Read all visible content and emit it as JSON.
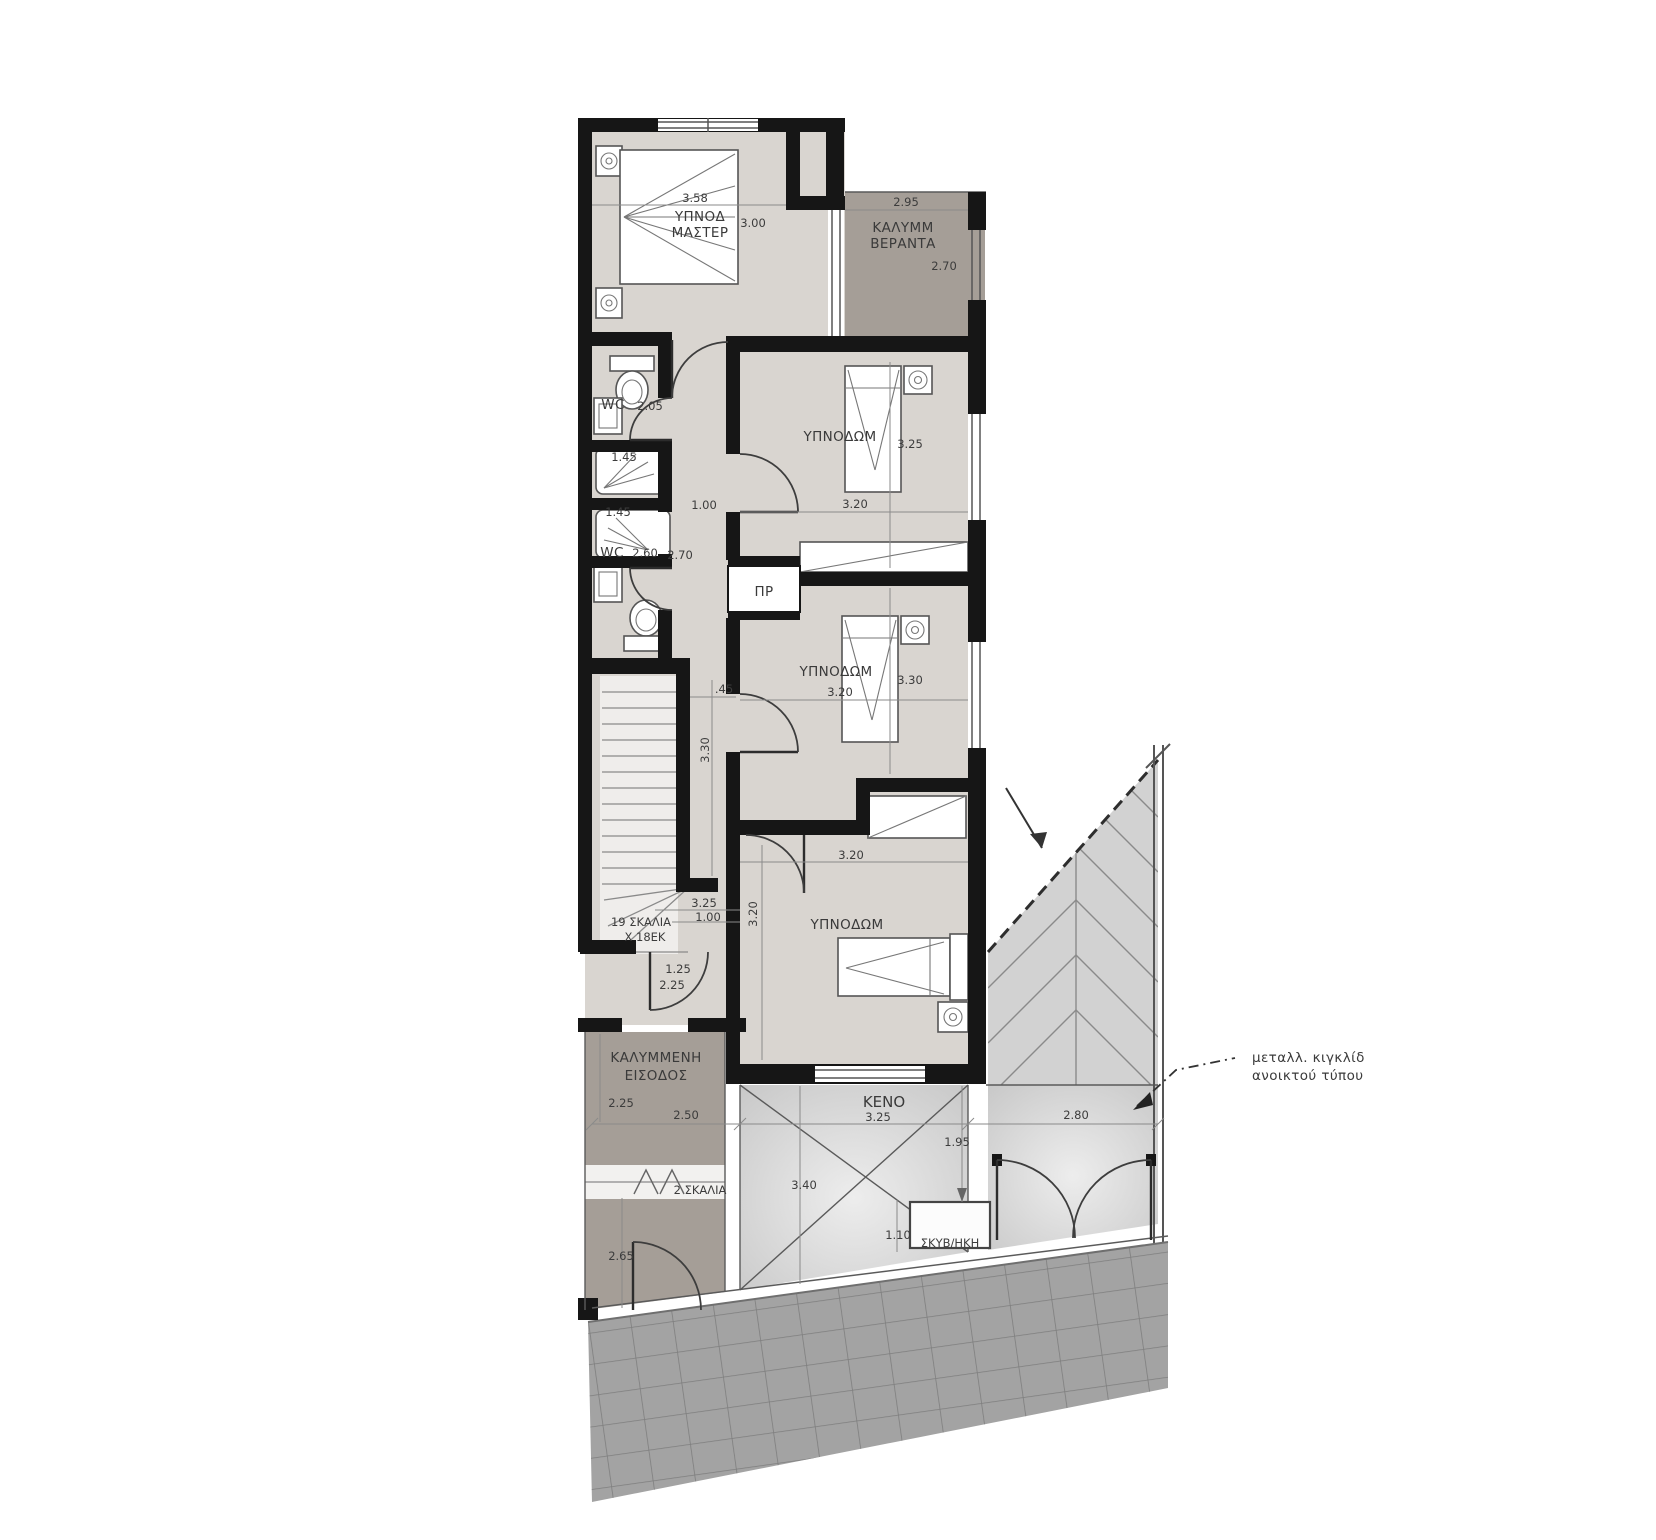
{
  "rooms": {
    "master": {
      "line1": "ΥΠΝΟΔ",
      "line2": "ΜΑΣΤΕΡ"
    },
    "veranda": {
      "line1": "ΚΑΛΥΜΜ",
      "line2": "ΒΕΡΑΝΤΑ"
    },
    "bedroom1": "ΥΠΝΟΔΩΜ",
    "bedroom2": "ΥΠΝΟΔΩΜ",
    "bedroom3": "ΥΠΝΟΔΩΜ",
    "wc1": "WC",
    "wc2": "WC",
    "closet": "ΠΡ",
    "stairs": {
      "line1": "19 ΣΚΑΛΙΑ",
      "line2": "Χ 18ΕΚ"
    },
    "steps2": "2 ΣΚΑΛΙΑ",
    "entrance": {
      "line1": "ΚΑΛΥΜΜΕΝΗ",
      "line2": "ΕΙΣΟΔΟΣ"
    },
    "void": "ΚΕΝΟ",
    "bin": "ΣΚΥΒ/ΗΚΗ"
  },
  "dims": {
    "master_w": "3.58",
    "master_h": "3.00",
    "veranda_w": "2.95",
    "veranda_h": "2.70",
    "wc1": "2.05",
    "shower1": "1.45",
    "shower2": "1.45",
    "wc2a": "2.60",
    "wc2b": "2.70",
    "corridor": "1.00",
    "bed1_h": "3.25",
    "bed1_w": "3.20",
    "bed2_h": "3.30",
    "bed2_w": "3.20",
    "offset": ".45",
    "hall_h": "3.30",
    "stair_w": "3.25",
    "stair_exit": "1.00",
    "entry_a": "1.25",
    "entry_b": "2.25",
    "bed3_w": "3.20",
    "bed3_h": "3.20",
    "porch_h": "2.25",
    "porch_w": "2.50",
    "void_w": "3.25",
    "void_h": "3.40",
    "side": "1.95",
    "gate": "2.80",
    "bin_h": "1.10",
    "lower_h": "2.65"
  },
  "annotations": {
    "railing": {
      "line1": "μεταλλ. κιγκλίδ",
      "line2": "ανοικτού τύπου"
    }
  },
  "colors": {
    "wall": "#161616",
    "interior": "#d9d5d0",
    "covered": "#a59e97",
    "paved": "#a3a3a3",
    "slope": "#d2d2d2",
    "voidfill": "#cdcdcd"
  }
}
